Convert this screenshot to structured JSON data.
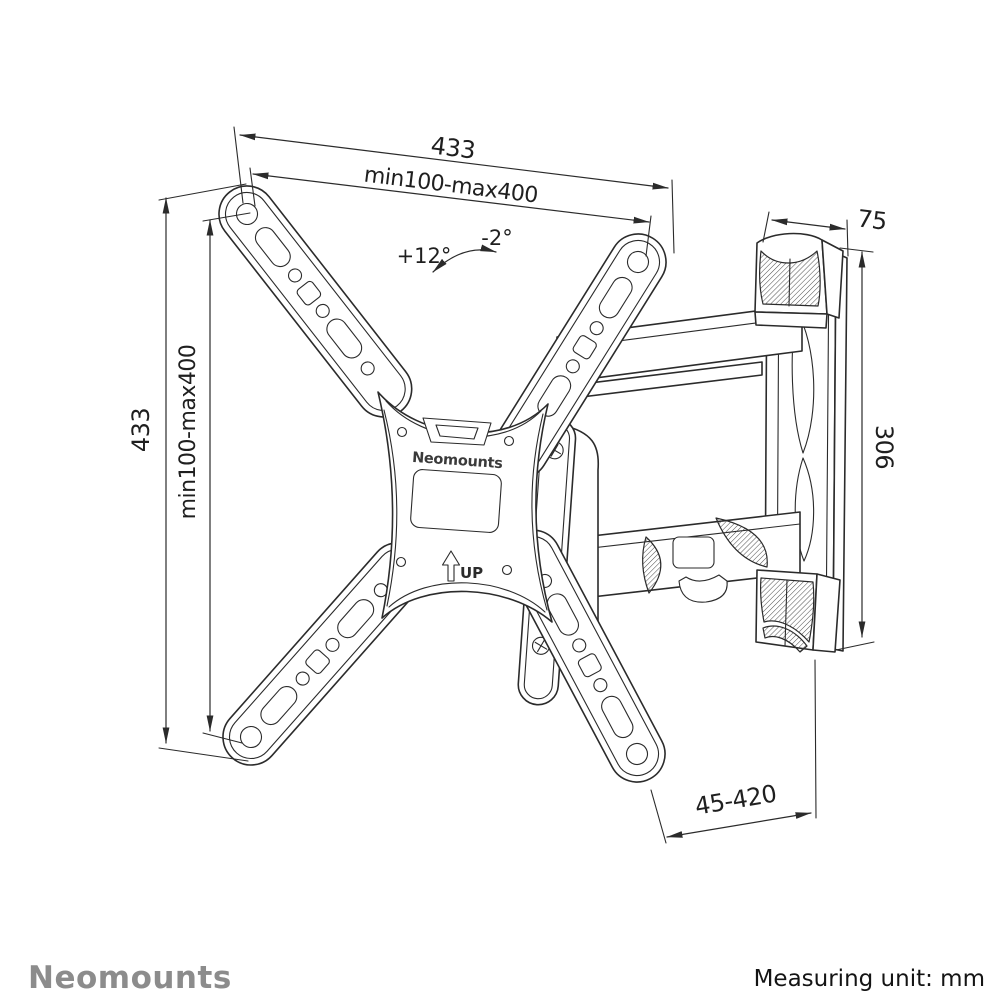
{
  "diagram": {
    "type": "technical-drawing",
    "subject": "full-motion TV wall mount bracket, isometric view",
    "dimensions": {
      "top_width": "433",
      "top_vesa_range": "min100-max400",
      "tilt_up_angle": "+12°",
      "tilt_down_angle": "-2°",
      "side_height": "433",
      "side_vesa_range": "min100-max400",
      "wall_plate_depth": "75",
      "wall_plate_height": "306",
      "arm_extension_range": "45-420"
    },
    "product_markings": {
      "brand_on_plate": "Neomounts",
      "orientation_label": "UP"
    }
  },
  "footer": {
    "brand_logo": "Neomounts",
    "measuring_unit_note": "Measuring unit: mm"
  },
  "colors": {
    "background": "#ffffff",
    "line_work": "#2b2b2b",
    "logo_gray": "#8c8c8c"
  }
}
